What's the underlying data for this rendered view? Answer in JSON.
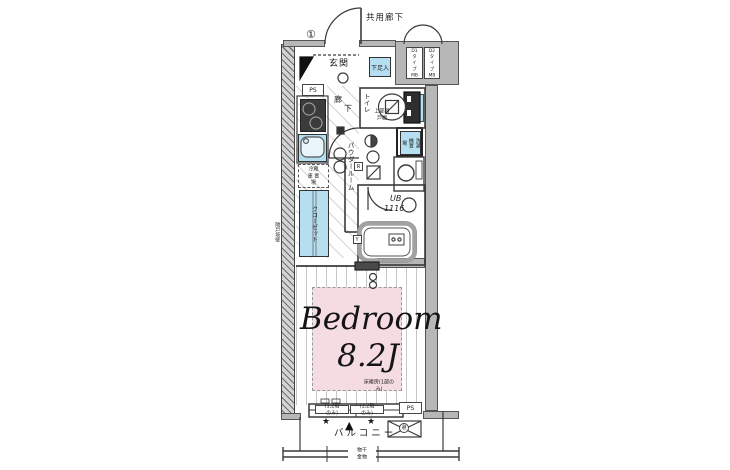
{
  "colors": {
    "wall_gray": "#b7b7b7",
    "fixture_blue": "#b5dff0",
    "heating_pink": "#f5dbe2",
    "mb_divider_cyan": "#4cc4da"
  },
  "labels": {
    "corridor": "共用廊下",
    "marker": "①",
    "mb_d1": "D1\nタイプ\nMB",
    "mb_d2": "D2\nタイプ\nMB",
    "genkan": "玄関",
    "shoe": "下足入",
    "ps_top": "PS",
    "ps_bottom": "PS",
    "hall_char1": "廊",
    "hall_char2": "下",
    "toilet": "トイレ",
    "toilet_note": "上部吊戸棚",
    "powder": "パウダールーム",
    "washer": "洗濯機置場",
    "fridge": "冷蔵庫\n置場",
    "closet": "クローゼット",
    "party_wall": "隣戸境壁",
    "bath_ub": "UB",
    "bath_size": "1116",
    "box_r": "R",
    "box_y": "Y",
    "bedroom_name": "Bedroom",
    "bedroom_size": "8.2J",
    "bedroom_note": "床暖房(1部のみ)",
    "window_note_left": "(1,2階のみ)",
    "window_note_right": "(1,2階のみ)",
    "star": "★",
    "triangle": "▲",
    "balcony": "バルコニー",
    "hanger": "物干金物",
    "hatch": "避"
  }
}
